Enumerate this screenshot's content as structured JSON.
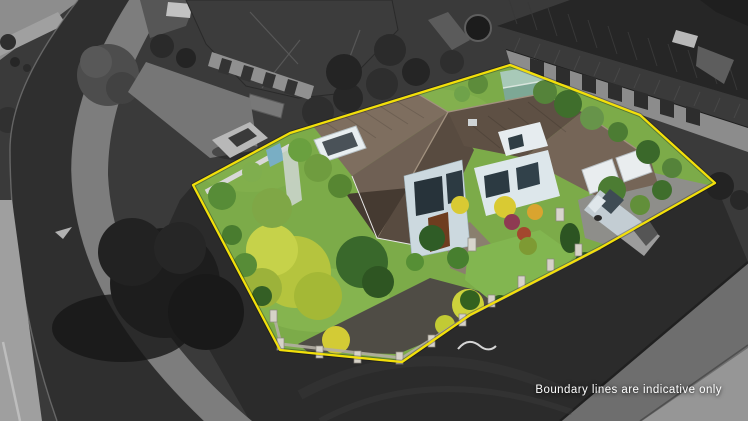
{
  "caption": {
    "text": "Boundary lines are indicative only",
    "color": "#ffffff"
  },
  "boundary": {
    "color": "#f2df0a",
    "style": "solid outline around property"
  },
  "palette": {
    "lawn_green": "#7cab49",
    "bright_shrub_yellow": "#d5ca35",
    "roof_brown": "#6b5c4f",
    "house_walls": "#d9e4e9",
    "shed_teal": "#8fb5a0",
    "van_silver": "#c3cdd3",
    "asphalt_dark": "#2c2c2c",
    "road_gray": "#6e6e6e"
  },
  "scene": {
    "type": "aerial-drone-photo",
    "effect": "surroundings desaturated to grayscale; property inside yellow boundary shown in colour",
    "objects": [
      "two-storey house with brown tiled roof",
      "double garage with white doors",
      "teal garden shed",
      "silver van parked on driveway",
      "lawns, chartreuse tree and garden beds",
      "low front fence with stone pillars",
      "curving street with footpaths (grayscale)",
      "neighbouring houses with dark roofs (grayscale)",
      "car parked on neighbouring driveway (grayscale)"
    ]
  }
}
